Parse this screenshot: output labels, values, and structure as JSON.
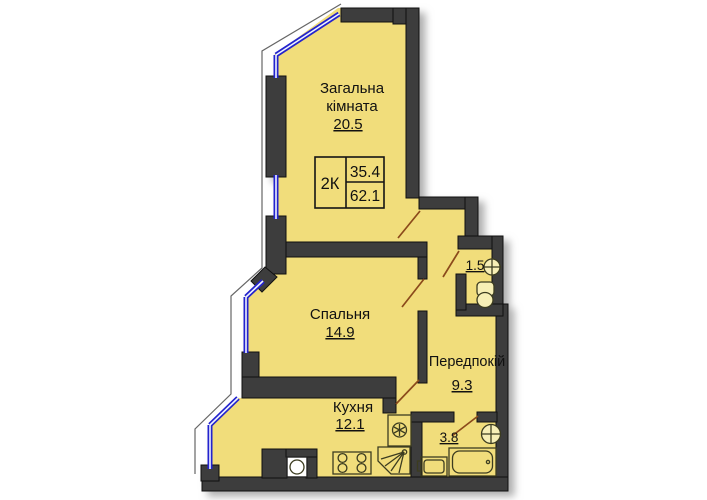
{
  "summary": {
    "type": "2К",
    "living_area": "35.4",
    "total_area": "62.1"
  },
  "living_room": {
    "name_line1": "Загальна",
    "name_line2": "кімната",
    "area": "20.5"
  },
  "bedroom": {
    "name": "Спальня",
    "area": "14.9"
  },
  "kitchen": {
    "name": "Кухня",
    "area": "12.1"
  },
  "hallway": {
    "name": "Передпокій",
    "area": "9.3"
  },
  "wc": {
    "area": "1.5"
  },
  "bathroom": {
    "area": "3.8"
  },
  "colors": {
    "floor": "#f1dd7b",
    "wall": "#3d3d3d",
    "window": "#2323cd",
    "door": "#8b4a1b"
  }
}
